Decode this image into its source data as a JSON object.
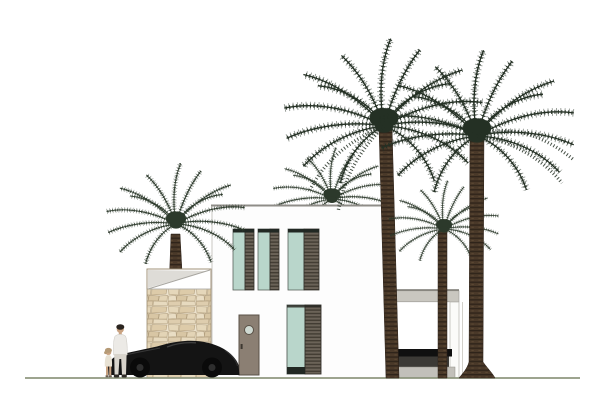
{
  "title": "Modern villa front elevation with palm trees",
  "scene": {
    "type": "architectural-elevation",
    "setting": "white minimalist two-storey villa on a single ground line",
    "elements": [
      "two-storey white house volume",
      "three upper-floor windows with teal glass and dark louvered shutters",
      "one ground-floor window with teal glass and louvered shutter",
      "taupe entry door with circular porthole",
      "beige stone feature wall with white parapet cap",
      "covered terrace with flat roof slab, white post and dark outdoor furniture",
      "black sports car parked in front",
      "adult figure and child figure standing by the car",
      "five dark green date palm trees"
    ],
    "counts": {
      "palm_trees": 5,
      "upper_windows": 3,
      "ground_windows": 1,
      "doors": 1,
      "vehicles": 1,
      "people": 2
    }
  },
  "palette": {
    "wall_white": "#fdfdfd",
    "outline_gray": "#c9c7c2",
    "roof_gray": "#8f8d88",
    "glass_teal": "#b9d6cb",
    "glass_frame": "#59625b",
    "louver_base": "#6b6358",
    "louver_dark": "#423c33",
    "lintel_dark": "#212823",
    "door_taupe": "#8b7f73",
    "door_frame": "#5a5147",
    "porthole": "#cfd9d2",
    "stone_base": "#ece2cd",
    "stone_edge": "#b3a07f",
    "stone_outline": "#9b8a6d",
    "cap_shade": "#dedcd7",
    "trunk_brown": "#4a3929",
    "trunk_dark": "#2f241a",
    "palm_dark": "#243024",
    "palm_mid": "#2c392b",
    "pavilion_gray": "#c9c7c0",
    "pavilion_line": "#77756f",
    "furniture_black": "#101010",
    "furniture_gray": "#3c3a36",
    "plinth_gray": "#c2c0ba",
    "ground_green": "#8f977f",
    "car_black": "#141414",
    "car_sheen": "#474747",
    "skin": "#c9a382",
    "shirt_white": "#eceae6",
    "pants_light": "#d8d4cc",
    "hair_dark": "#2a241f",
    "hair_child": "#b59a76"
  }
}
